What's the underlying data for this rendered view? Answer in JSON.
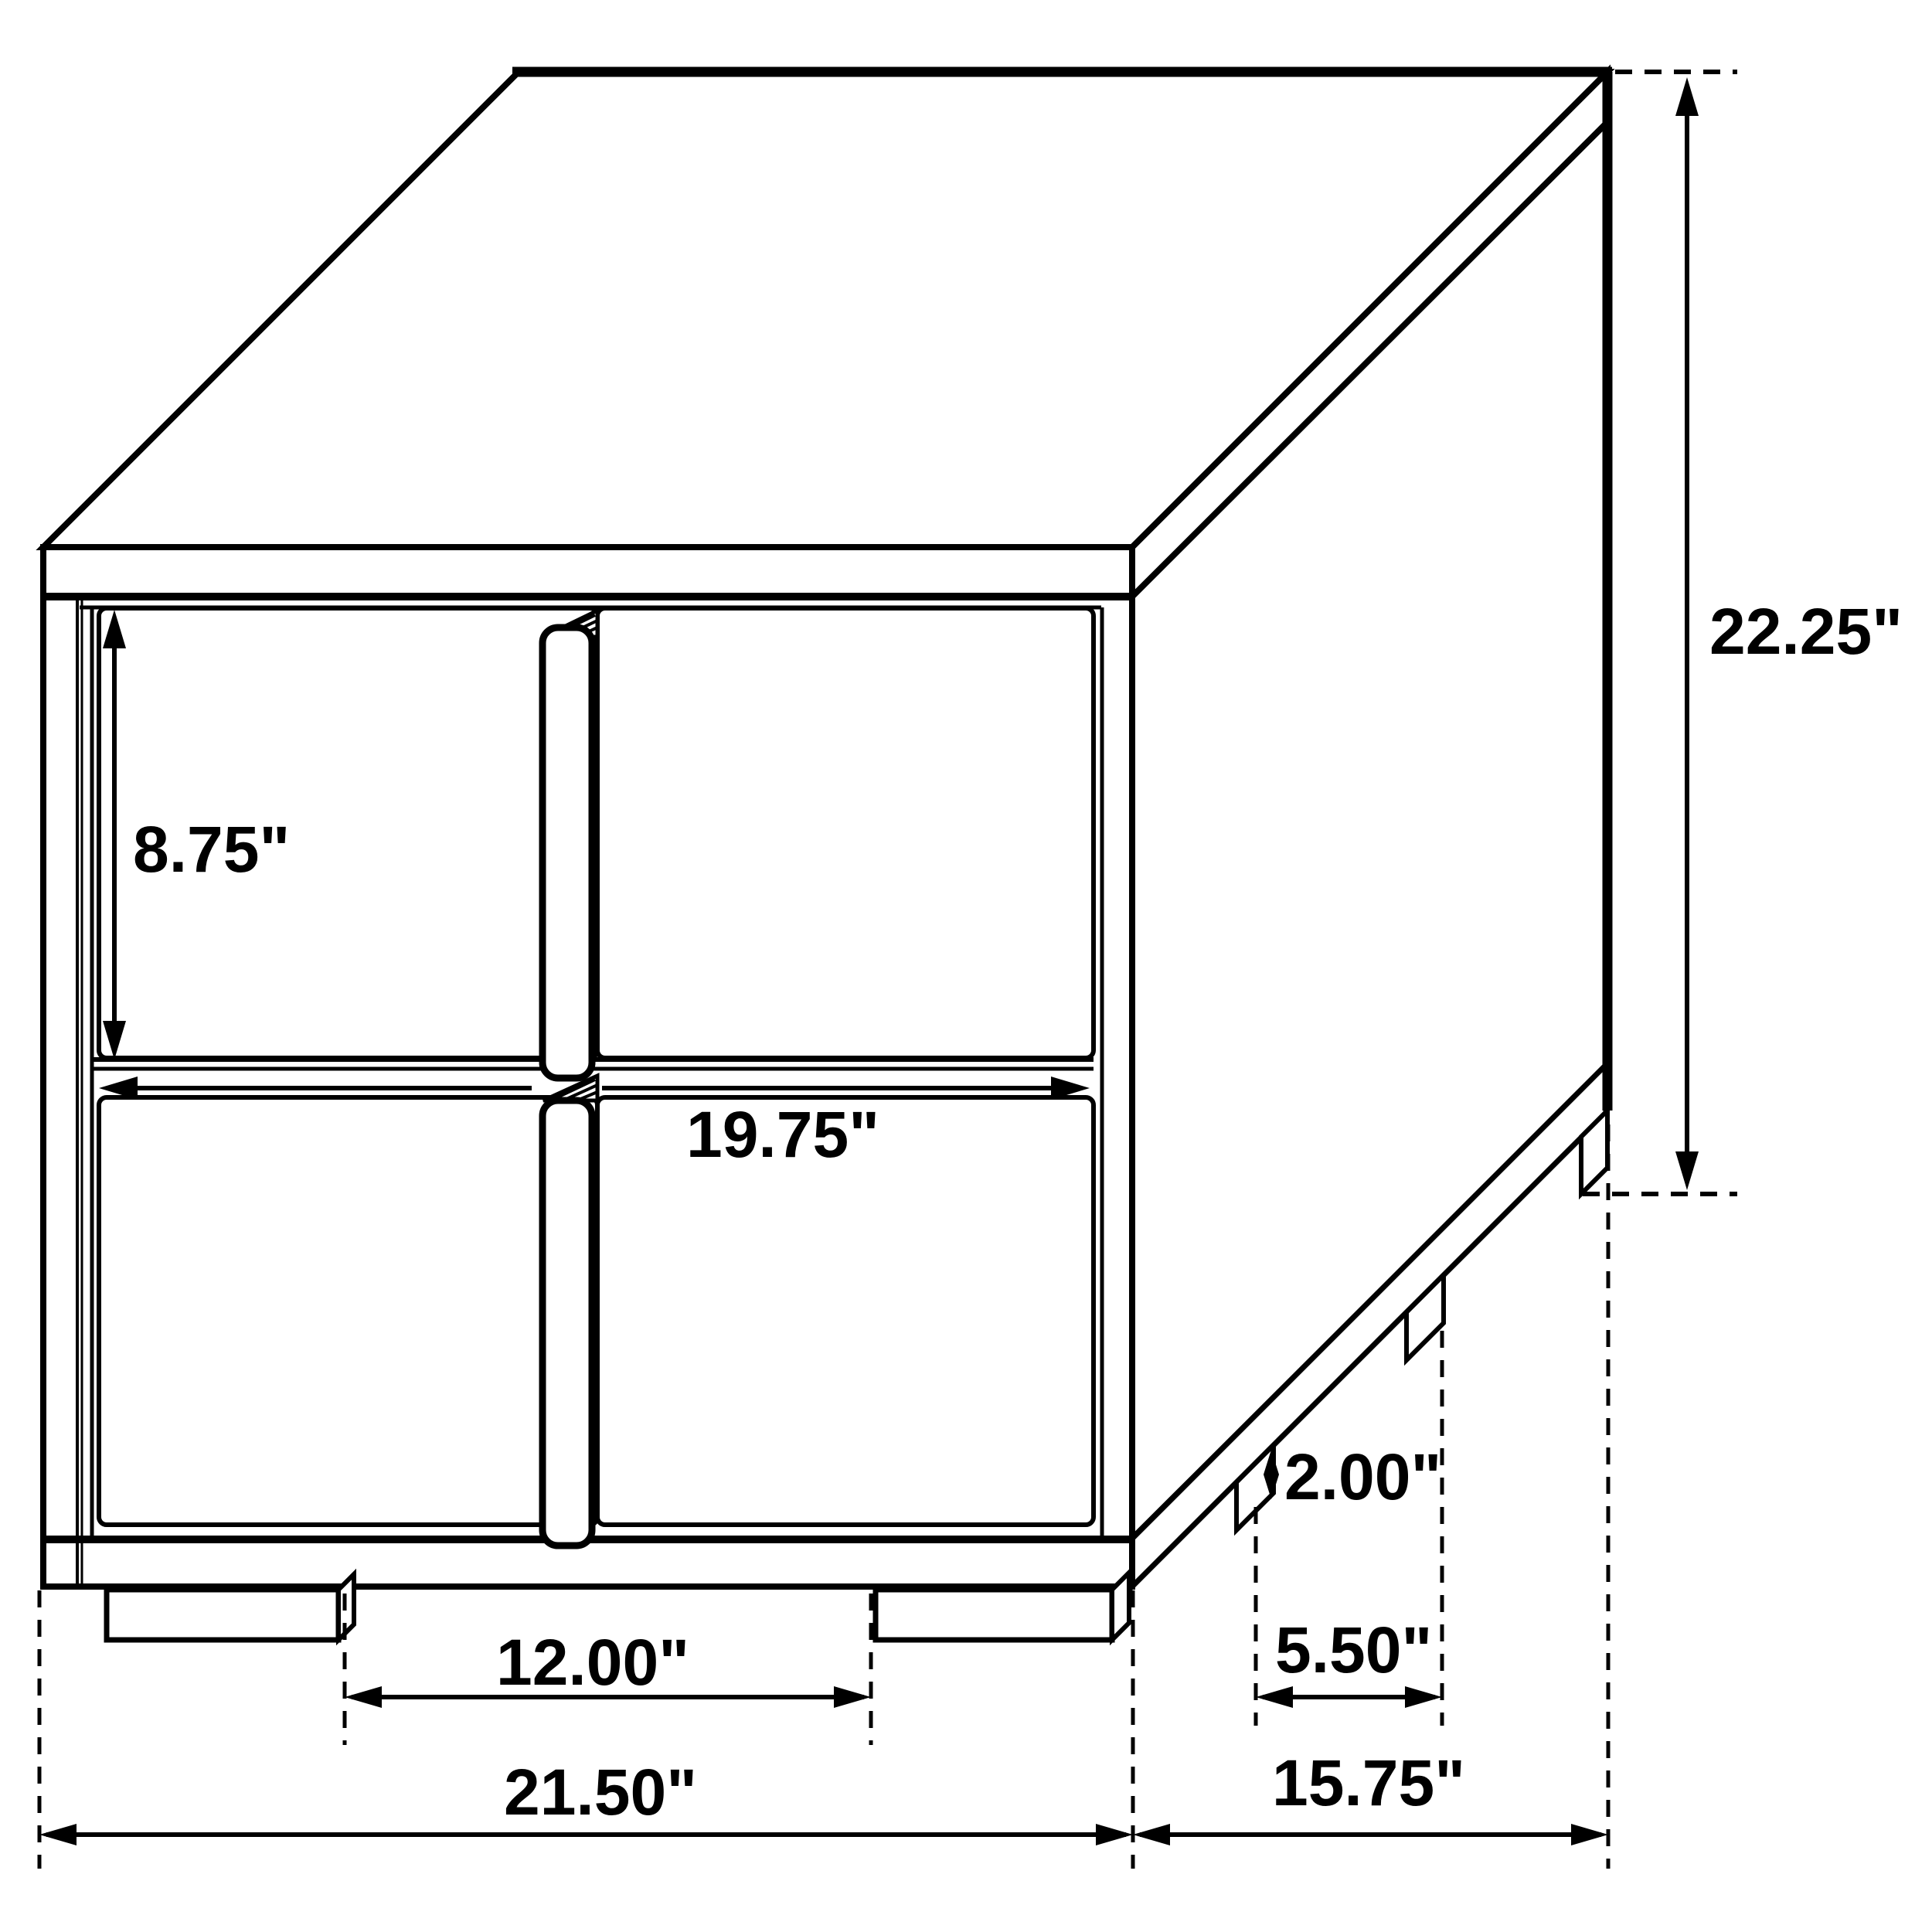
{
  "diagram": {
    "kind": "furniture-dimension-drawing",
    "unit": "inches",
    "labels": {
      "drawer_height": "8.75\"",
      "drawer_width": "19.75\"",
      "overall_height": "22.25\"",
      "foot_height": "2.00\"",
      "side_foot_spacing": "5.50\"",
      "front_foot_spacing": "12.00\"",
      "overall_width": "21.50\"",
      "overall_depth": "15.75\""
    },
    "colors": {
      "line": "#000000",
      "background": "#ffffff"
    }
  }
}
